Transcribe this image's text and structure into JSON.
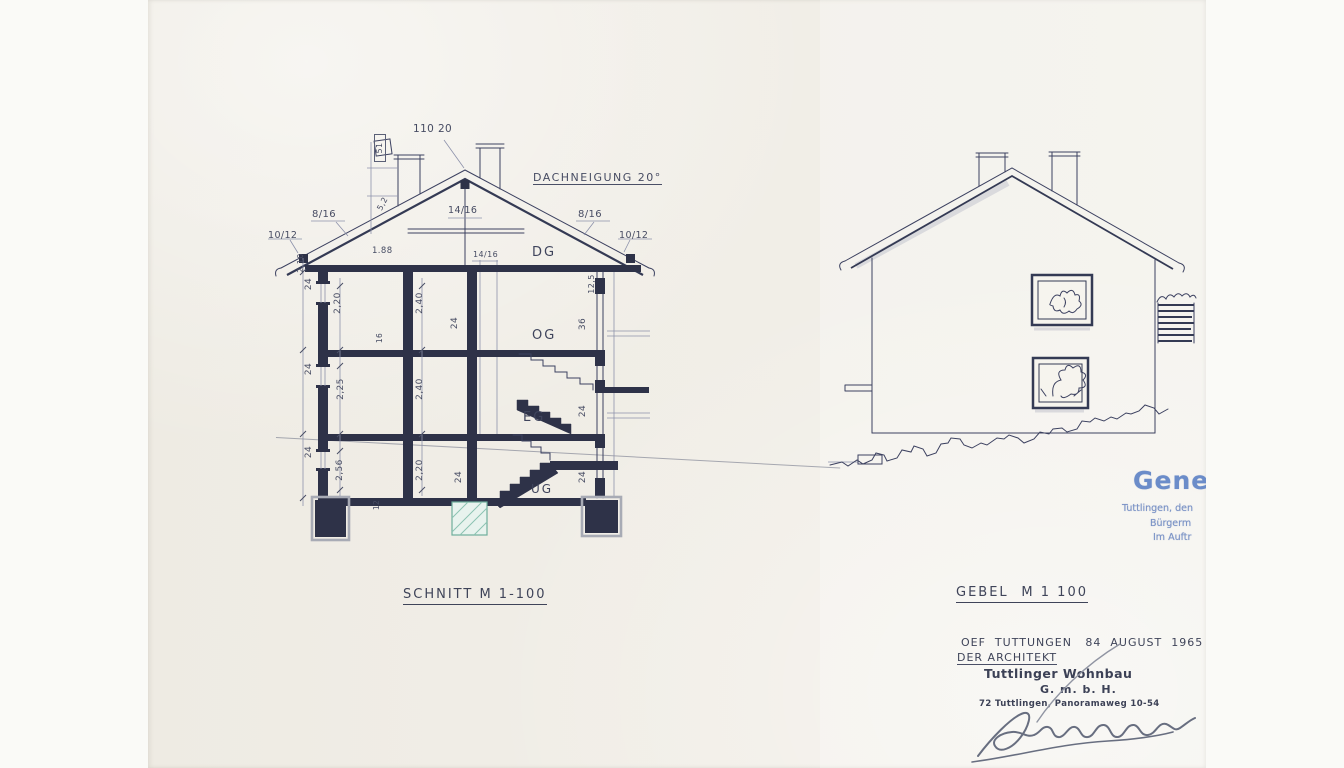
{
  "section": {
    "title": "SCHNITT M 1-100",
    "ridge_dim": "110 20",
    "roof_pitch": "DACHNEIGUNG 20°",
    "rafters": {
      "left": "8/16",
      "collar": "14/16",
      "right": "8/16",
      "eave_left": "10/12",
      "eave_right": "10/12",
      "purlin": "14/16"
    },
    "storeys": {
      "attic": "DG",
      "upper": "OG",
      "ground": "EG",
      "basement": "UG"
    },
    "dims": {
      "d188": "1.88",
      "h_attic_left": "2,20",
      "h_attic_mid": "2,40",
      "h_upper_left": "2,25",
      "h_upper_mid": "2,40",
      "h_lower_left": "2,56",
      "h_lower_mid": "2,20",
      "wall24": "24",
      "wall36": "36",
      "wall16": "16",
      "wall12": "12",
      "eave_depth": "12,5",
      "parapet": "2,10",
      "chimney_head": "51",
      "roof_edge": "5,2"
    }
  },
  "elevation": {
    "title": "GEBEL",
    "scale": "M  1 100"
  },
  "approval": {
    "word": "Gene",
    "line1": "Tuttlingen, den",
    "line2": "Bürgerm",
    "line3": "Im Auftr"
  },
  "footer": {
    "dateline": "OEF  TUTTUNGEN   84  AUGUST  1965",
    "architect": "DER ARCHITEKT",
    "stamp_name": "Tuttlinger Wohnbau",
    "stamp_gmbh": "G. m. b. H.",
    "stamp_address": "72 Tuttlingen, Panoramaweg 10-54"
  }
}
